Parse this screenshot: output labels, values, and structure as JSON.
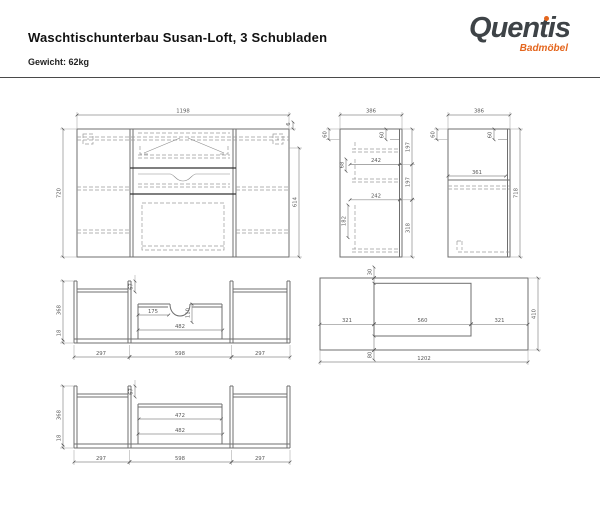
{
  "header": {
    "title": "Waschtischunterbau Susan-Loft, 3 Schubladen",
    "weight": "Gewicht: 62kg"
  },
  "logo": {
    "name": "Quentis",
    "subtitle": "Badmöbel",
    "text_color": "#3e4347",
    "accent_color": "#e4661e"
  },
  "views": {
    "front": {
      "dims": {
        "width": "1198",
        "height": "720",
        "inner_height": "614",
        "top_gap": "6"
      }
    },
    "section": {
      "dims": {
        "width": "386",
        "top_offset": "60",
        "top_inner": "60",
        "seg1": "197",
        "seg2": "197",
        "seg3": "318",
        "depth1": "242",
        "depth2": "242",
        "front1": "68",
        "front2": "182"
      }
    },
    "side": {
      "dims": {
        "width": "386",
        "top_offset": "60",
        "top_inner": "60",
        "shelf": "361",
        "height": "718"
      }
    },
    "plan_top_drawer": {
      "dims": {
        "depth": "368",
        "back": "18",
        "front": "67",
        "notch_left": "175",
        "notch_depth": "110",
        "inner_width": "482",
        "left": "297",
        "center": "598",
        "right": "297"
      }
    },
    "worktop": {
      "dims": {
        "front_gap": "30",
        "left": "321",
        "cutout": "560",
        "right": "321",
        "back_gap": "80",
        "depth": "410",
        "width": "1202"
      }
    },
    "plan_lower_drawer": {
      "dims": {
        "depth": "368",
        "back": "18",
        "front": "67",
        "inner_top": "472",
        "inner_width": "482",
        "left": "297",
        "center": "598",
        "right": "297"
      }
    }
  }
}
